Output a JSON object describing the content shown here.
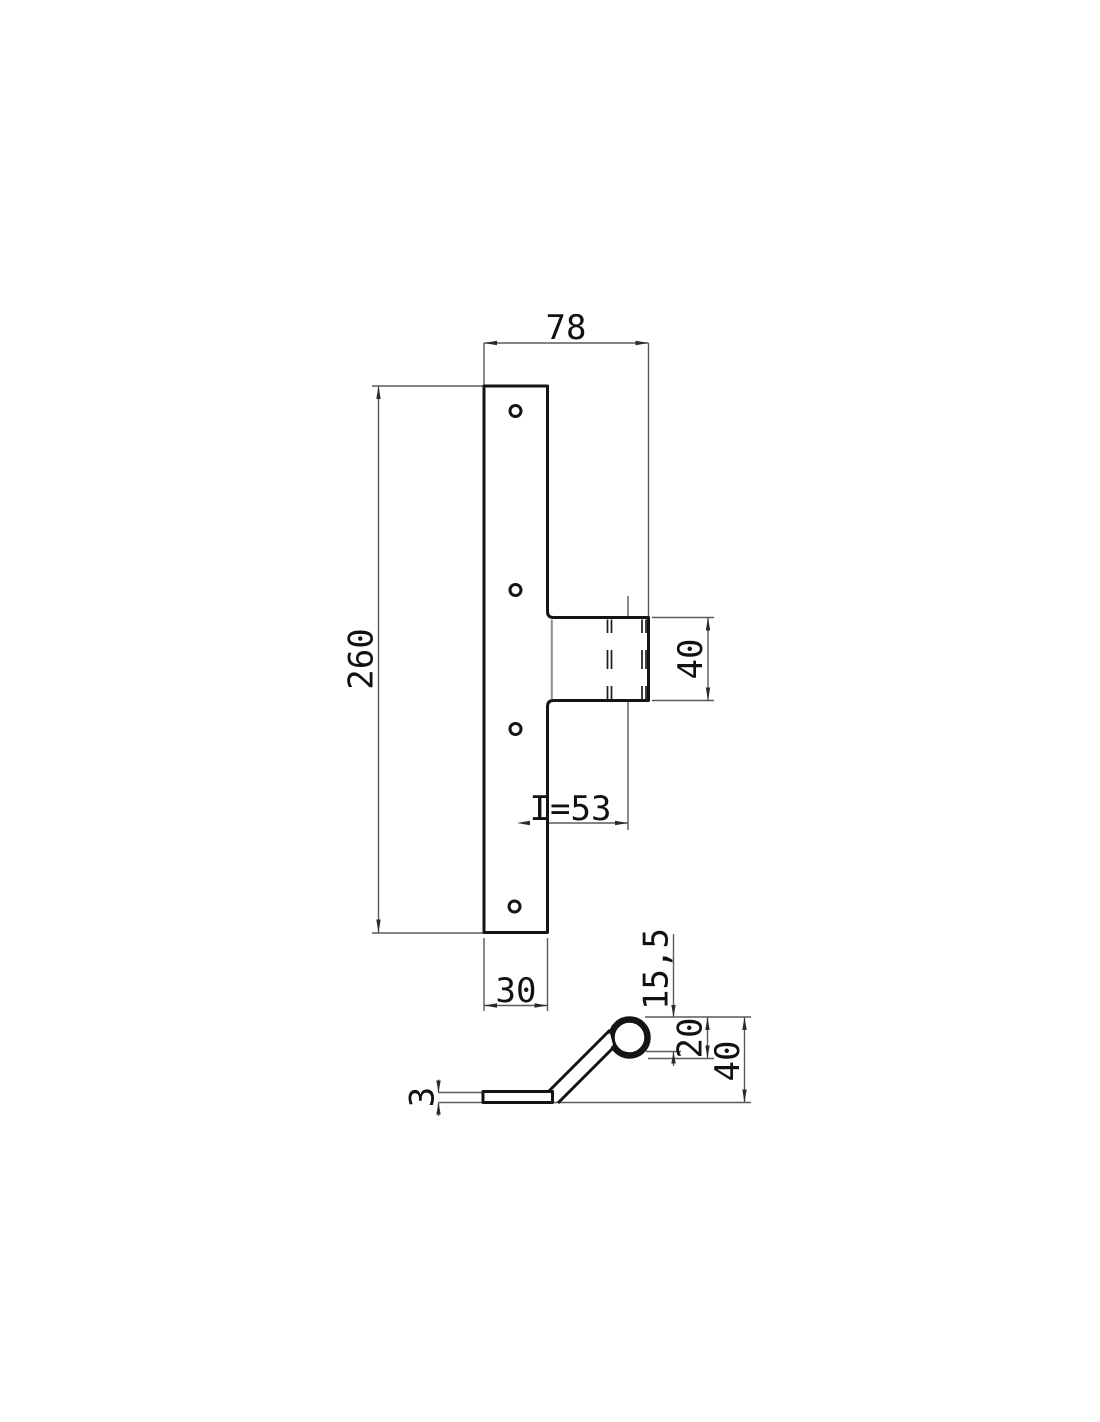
{
  "drawing": {
    "kind": "technical-drawing-2-views",
    "front_view": {
      "dims": {
        "width_top": "78",
        "height": "260",
        "tab_height": "40",
        "hole_to_center": "I=53",
        "width_bottom": "30"
      }
    },
    "side_view": {
      "dims": {
        "eye_depth": "15,5",
        "eye_diameter": "20",
        "total_height": "40",
        "thickness": "3"
      }
    },
    "colors": {
      "object_line": "#141414",
      "thin_line": "#5a5a5a",
      "fold_line": "#8f8f8f",
      "text": "#111111",
      "background": "#ffffff"
    }
  }
}
